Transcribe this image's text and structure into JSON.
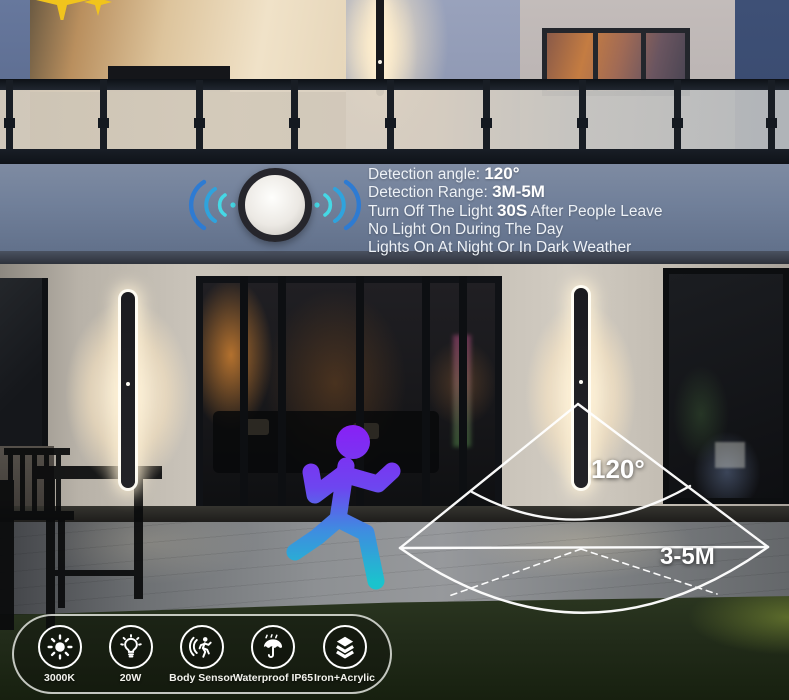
{
  "sensor_panel": {
    "lines": [
      {
        "pre": "Detection angle: ",
        "bold": "120°",
        "post": ""
      },
      {
        "pre": "Detection Range: ",
        "bold": "3M-5M",
        "post": ""
      },
      {
        "pre": "Turn Off The Light ",
        "bold": "30S",
        "post": " After People Leave"
      },
      {
        "pre": "No Light On During The Day",
        "bold": "",
        "post": ""
      },
      {
        "pre": "Lights On At Night Or In Dark Weather",
        "bold": "",
        "post": ""
      }
    ]
  },
  "detection_cone": {
    "angle_label": "120°",
    "range_label": "3-5M"
  },
  "features_bar": {
    "items": [
      {
        "icon": "color-temperature-sun-icon",
        "label": "3000K"
      },
      {
        "icon": "wattage-bulb-icon",
        "label": "20W"
      },
      {
        "icon": "body-sensor-icon",
        "label": "Body Sensor"
      },
      {
        "icon": "waterproof-umbrella-icon",
        "label": "Waterproof IP65"
      },
      {
        "icon": "material-layers-icon",
        "label": "Iron+Acrylic"
      }
    ]
  },
  "colors": {
    "wave_cyan": "#45d8e5",
    "wave_blue": "#2e7bd2",
    "runner_top": "#8a1ef5",
    "runner_bottom": "#1bc3cd",
    "cone_line": "#ffffff",
    "sparkle_yellow": "#f1c41c",
    "lamp_glow": "#ffe9c4"
  }
}
